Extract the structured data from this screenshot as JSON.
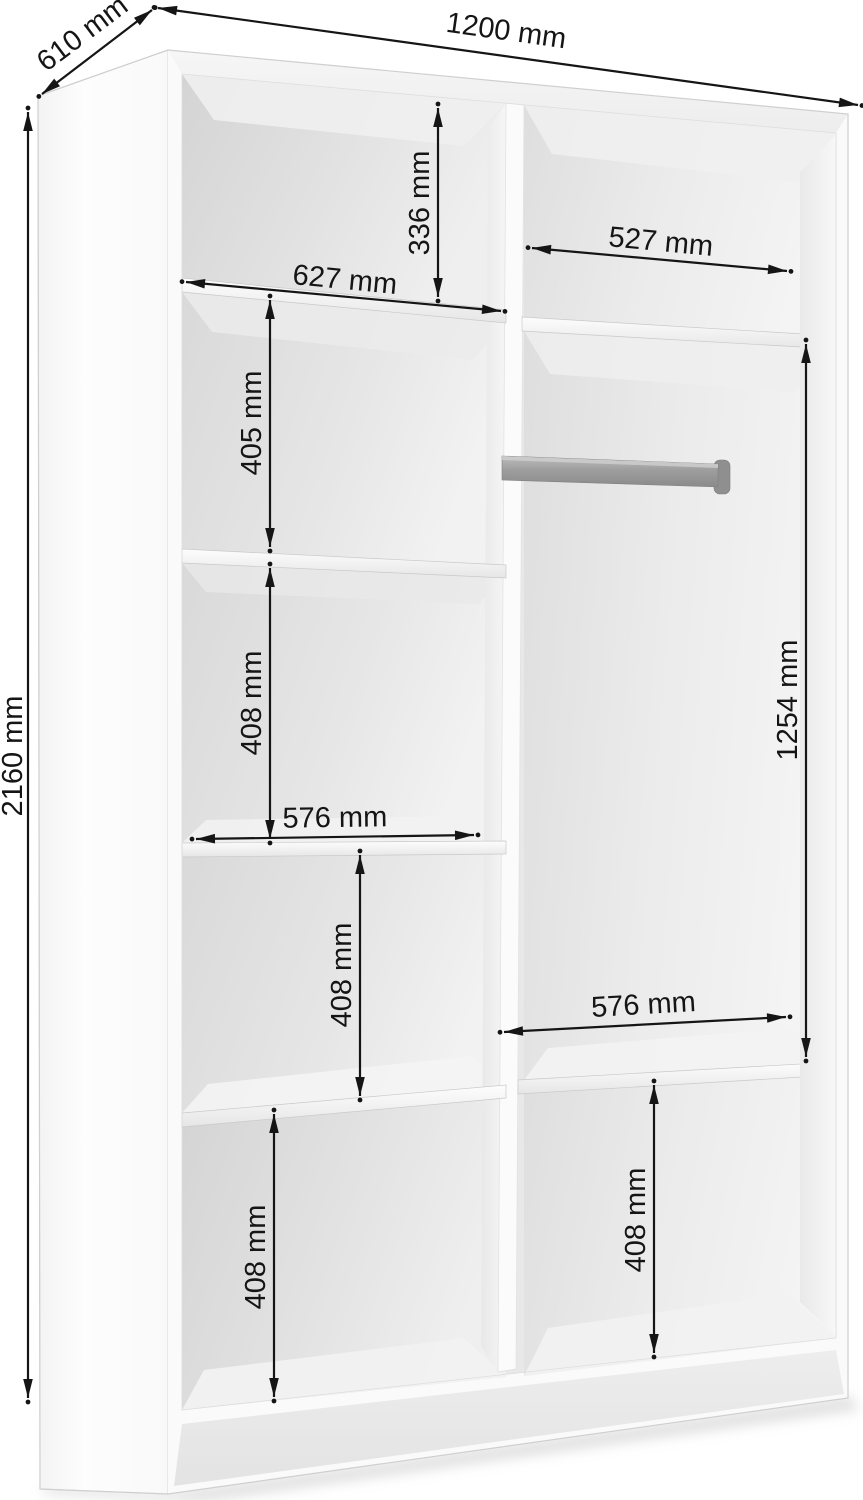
{
  "diagram": {
    "type": "furniture-dimension-drawing",
    "dimensions": {
      "overall_width": "1200 mm",
      "overall_depth": "610 mm",
      "overall_height": "2160 mm",
      "top_left_section_height": "336 mm",
      "left_section_width": "627 mm",
      "right_section_width": "527 mm",
      "left_shelf_gap_1": "405 mm",
      "left_shelf_gap_2": "408 mm",
      "left_lower_width": "576 mm",
      "left_shelf_gap_3": "408 mm",
      "left_bottom_section_height": "408 mm",
      "hanging_section_height": "1254 mm",
      "right_lower_width": "576 mm",
      "right_bottom_section_height": "408 mm"
    },
    "colors": {
      "dimension_line": "#151515",
      "cabinet_face": "#fafafa",
      "interior_shadow": "#d6d6d6",
      "hanging_rail": "#9a9a9a",
      "background": "#ffffff"
    }
  }
}
